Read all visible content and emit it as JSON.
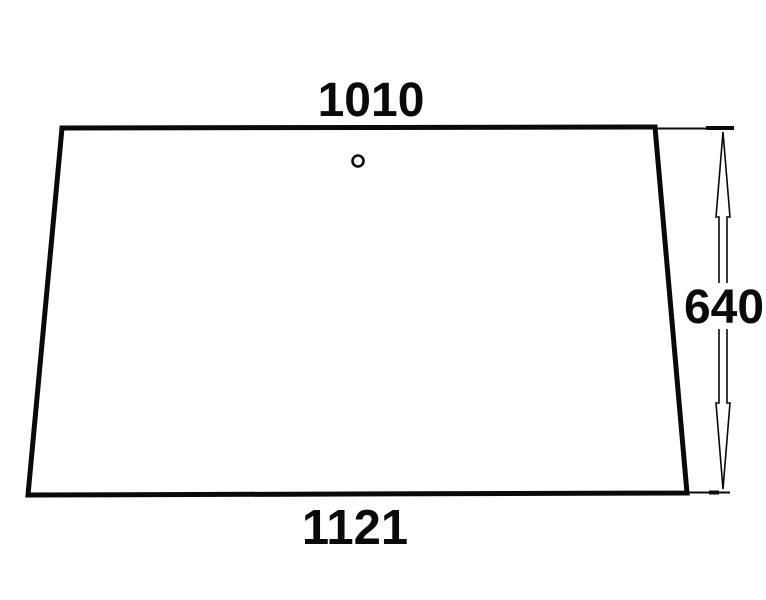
{
  "diagram": {
    "kind": "technical-dimension-drawing",
    "shape": "trapezoid-panel-with-hole",
    "dimensions": {
      "top_width": "1010",
      "bottom_width": "1121",
      "right_height": "640"
    },
    "colors": {
      "line": "#0a0a0a",
      "background": "#ffffff",
      "text": "#0a0a0a"
    }
  }
}
